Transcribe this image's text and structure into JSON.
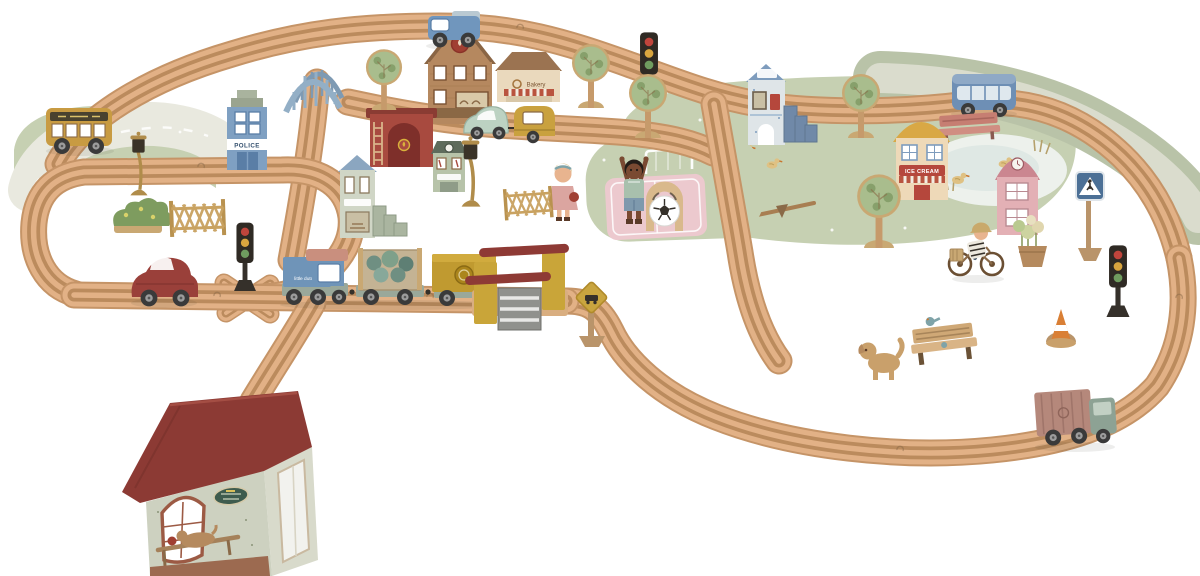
{
  "scene": {
    "title": "Little Dutch wooden toy railway train set - product photo on white background",
    "background_color": "#ffffff",
    "labels": {
      "police_sign": "POLICE",
      "engine_brand": "little dutch",
      "ice_cream_sign": "ICE CREAM",
      "bakery_sign": "Bakery"
    },
    "palette": {
      "track_outline": "#c59467",
      "track_face": "#e2b186",
      "track_groove": "#bb8b5d",
      "mat_road": "#e9e9df",
      "mat_green": "#c6d0b2",
      "mat_road2": "#b9c3a8",
      "mat_road2_inner": "#dadccd",
      "pond": "#edf1ec",
      "pink_field": "#ecc9ce",
      "wood": "#c9a873",
      "wood_dark": "#8a6a48",
      "red_roof": "#8c3a34",
      "red_building": "#a84a3f",
      "barrier_red": "#8e3a35",
      "blue_building": "#7fa0c2",
      "bus_blue": "#6e8fb5",
      "sage": "#b7c3a9",
      "cream": "#ead9bd",
      "mustard": "#c9a539",
      "bus_yellow": "#c89b42",
      "engine_blue": "#6f94b8",
      "salmon": "#c98f7e",
      "mint": "#bcd2c2",
      "leaf_green": "#a9bd8d",
      "leaf_dark": "#87a06b",
      "dark": "#35302a"
    },
    "inventory": [
      {
        "name": "wooden-track-network",
        "color": "#e2b186"
      },
      {
        "name": "left-road-mat-with-yellow-school-bus",
        "color": "#e9e9df"
      },
      {
        "name": "elevated-track-with-blue-arch-bridge-and-ramp",
        "color": "#93afc6"
      },
      {
        "name": "blue-pickup-truck",
        "color": "#7096bd"
      },
      {
        "name": "school-building-with-flame-emblem",
        "color": "#b5885f"
      },
      {
        "name": "bakery-shop-with-striped-awning",
        "color": "#ead9bd"
      },
      {
        "name": "police-station-blue",
        "color": "#7fa0c2"
      },
      {
        "name": "fire-station-red-with-ladder",
        "color": "#a84a3f"
      },
      {
        "name": "green-clock-townhouse",
        "color": "#b7c3a9"
      },
      {
        "name": "blue-gable-house-with-steps",
        "color": "#d0d6c6"
      },
      {
        "name": "mint-car-towing-yellow-caravan",
        "color": "#bcd2c2"
      },
      {
        "name": "red-beetle-car",
        "color": "#9a403a"
      },
      {
        "name": "blue-engine-with-two-wagons",
        "color": "#6f94b8"
      },
      {
        "name": "level-crossing-with-red-barriers",
        "color": "#c9a539"
      },
      {
        "name": "railroad-crossing-sign",
        "color": "#c9a53f"
      },
      {
        "name": "playground-mat-with-pink-pitch-boy-and-football",
        "color": "#ecc9ce"
      },
      {
        "name": "girl-figure-by-fence",
        "color": "#dba5a0"
      },
      {
        "name": "two-lattice-fences",
        "color": "#c9a260"
      },
      {
        "name": "flower-bush",
        "color": "#7e9c5f"
      },
      {
        "name": "two-street-lamps",
        "color": "#b08c4a"
      },
      {
        "name": "three-traffic-lights",
        "color": "#35302a"
      },
      {
        "name": "bus-stop-tower-with-blue-steps",
        "color": "#9db8cf"
      },
      {
        "name": "blue-city-bus",
        "color": "#6e8fb5"
      },
      {
        "name": "pond-mat-with-ducks-and-curved-road",
        "color": "#c6d0b2"
      },
      {
        "name": "ice-cream-shop-with-arched-yellow-roof",
        "color": "#d9a845"
      },
      {
        "name": "pink-clock-tower",
        "color": "#e3b0b5"
      },
      {
        "name": "red-park-bench",
        "color": "#c67e72"
      },
      {
        "name": "pedestrian-crossing-sign",
        "color": "#4c7096"
      },
      {
        "name": "cyclist-figure-with-basket",
        "color": "#c9a96b"
      },
      {
        "name": "flower-basket-piece",
        "color": "#cdd3a0"
      },
      {
        "name": "wooden-dog",
        "color": "#c9a06b"
      },
      {
        "name": "wooden-bench-with-bird",
        "color": "#cfa876"
      },
      {
        "name": "traffic-cone",
        "color": "#d97f35"
      },
      {
        "name": "green-truck-with-container",
        "color": "#8da294"
      },
      {
        "name": "five-trees",
        "color": "#a9bd8d"
      },
      {
        "name": "large-station-house-red-roof",
        "color": "#8c3a34"
      }
    ]
  }
}
